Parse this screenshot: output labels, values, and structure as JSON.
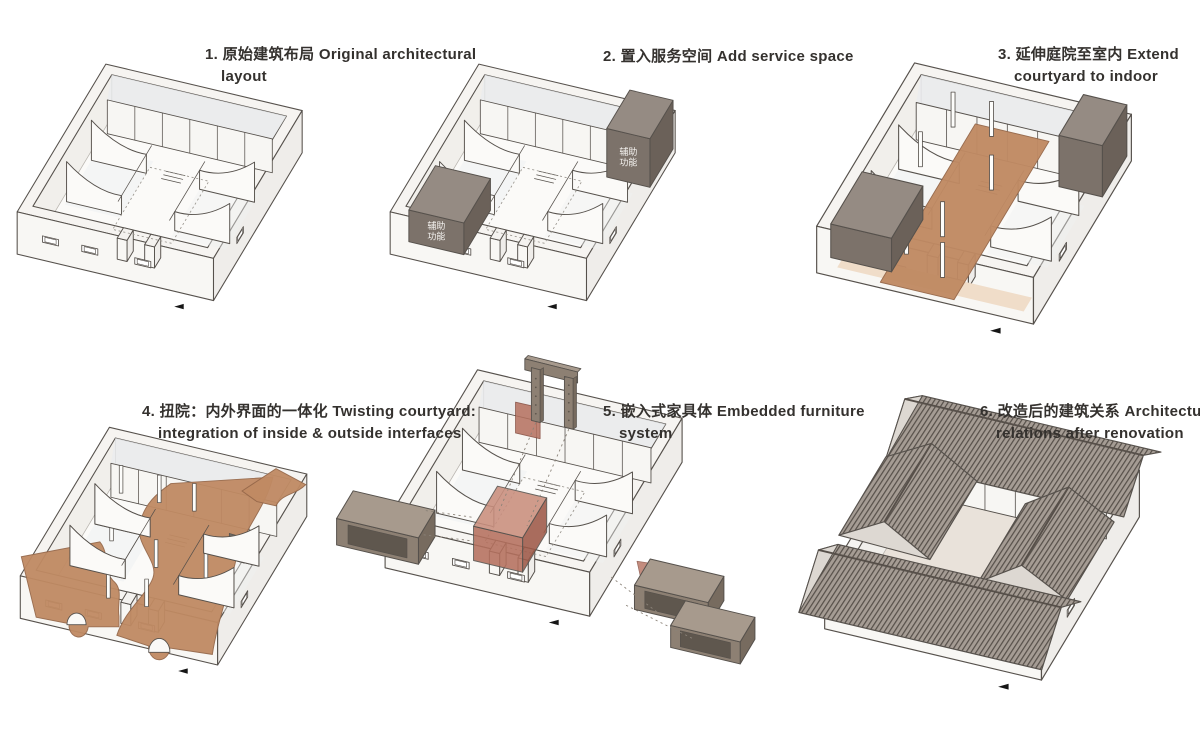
{
  "page": {
    "background": "#ffffff"
  },
  "colors": {
    "line": "#56514c",
    "wall_light": "#f6f4f1",
    "wall_face": "#f8f7f4",
    "wall_shade": "#efedea",
    "inner_shade": "#edebe7",
    "deck_tint": "#e9ecef",
    "floor": "#fbfaf8",
    "floor_renovated": "#e9e2da",
    "terracotta": "#c08a63",
    "terracotta_light": "#f0ddc9",
    "terracotta_edge": "#96684a",
    "dark_box_top": "#958b83",
    "dark_box_front": "#7c726a",
    "dark_box_side": "#6b6159",
    "furniture_top": "#a79a8d",
    "furniture_front": "#8d8073",
    "furniture_side": "#776b5f",
    "furniture_inner": "#5f574e",
    "red_box": "#b5705e",
    "red_box_top": "#c98e7d",
    "red_box_side": "#9e5948",
    "red_edge": "#83483a",
    "roof_base": "#a59c94",
    "roof_line": "#57504a",
    "gable": "#ddd8d2",
    "marker": "#161616",
    "box_label_text": "#f5f3f0",
    "caption_text": "#34312e"
  },
  "panels": [
    {
      "step": 1,
      "caption_lines": [
        "1. 原始建筑布局 Original architectural",
        "layout"
      ]
    },
    {
      "step": 2,
      "caption_lines": [
        "2. 置入服务空间 Add service space"
      ],
      "service_box_label": [
        "辅助",
        "功能"
      ]
    },
    {
      "step": 3,
      "caption_lines": [
        "3. 延伸庭院至室内 Extend",
        "courtyard to indoor"
      ]
    },
    {
      "step": 4,
      "caption_lines": [
        "4. 扭院：内外界面的一体化 Twisting courtyard:",
        "integration of inside & outside interfaces"
      ]
    },
    {
      "step": 5,
      "caption_lines": [
        "5. 嵌入式家具体 Embedded furniture",
        "system"
      ]
    },
    {
      "step": 6,
      "caption_lines": [
        "6. 改造后的建筑关系 Architectural",
        "relations after renovation"
      ]
    }
  ]
}
